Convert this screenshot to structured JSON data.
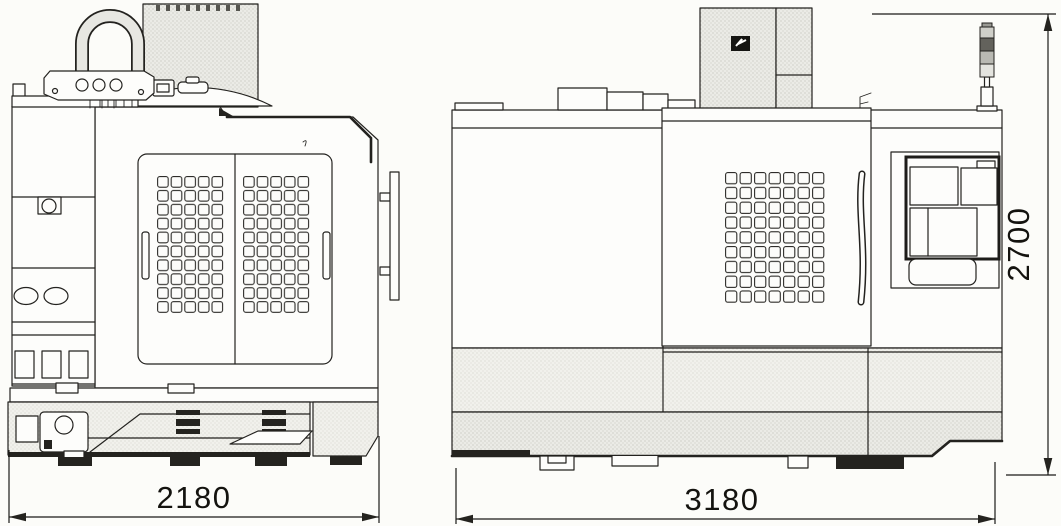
{
  "drawing": {
    "description": "machine outline drawing with front and side elevation views",
    "views": {
      "front": {
        "name": "front-elevation",
        "width_label": "2180"
      },
      "side": {
        "name": "side-elevation",
        "length_label": "3180",
        "height_label": "2700"
      }
    },
    "dimensions": {
      "front_width": "2180",
      "side_length": "3180",
      "height": "2700"
    },
    "icons": {
      "brand_logo": "lightning-logo-badge",
      "signal_tower": "stack-light-icon",
      "lifting_shackle": "shackle-icon"
    },
    "colors": {
      "paper": "#fcfcf9",
      "line": "#23221f",
      "hatch": "#ebebe7",
      "dark": "#24231f"
    }
  }
}
